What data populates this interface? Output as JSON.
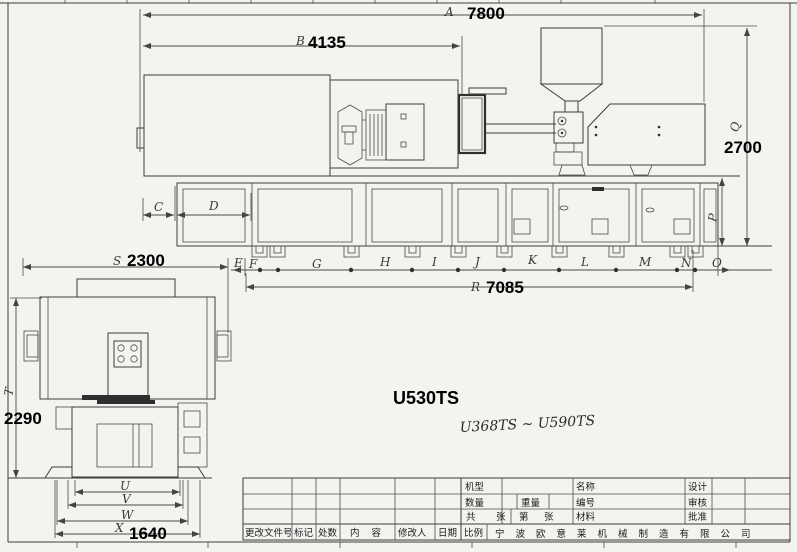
{
  "annotations": {
    "model_label": "U530TS",
    "model_range_note": "U368TS ~ U590TS"
  },
  "dimensions": {
    "overall_length": {
      "letter": "A",
      "value": "7800"
    },
    "injection_length": {
      "letter": "B",
      "value": "4135"
    },
    "machine_height": {
      "letter": "Q",
      "value": "2700"
    },
    "base_height_letter": "P",
    "c_letter": "C",
    "d_letter": "D",
    "foot_letters": [
      "E",
      "F",
      "G",
      "H",
      "I",
      "J",
      "K",
      "L",
      "M",
      "N",
      "O"
    ],
    "foot_span": {
      "letter": "R",
      "value": "7085"
    },
    "machine_width": {
      "letter": "S",
      "value": "2300"
    },
    "end_height": {
      "letter": "T",
      "value": "2290"
    },
    "u_letter": "U",
    "v_letter": "V",
    "w_letter": "W",
    "pedestal_width": {
      "letter": "X",
      "value": "1640"
    }
  },
  "title_block": {
    "machine_type_label": "机型",
    "quantity_label": "数量",
    "weight_label": "重量",
    "total_label": "共",
    "sheets_label": "张",
    "no_label": "第",
    "sheet_label": "张",
    "material_label": "材料",
    "name_label": "名称",
    "code_label": "编号",
    "design_label": "设计",
    "check_label": "审核",
    "approve_label": "批准",
    "scale_label": "比例",
    "change_file_label": "更改文件号",
    "mark_label": "标记",
    "count_label": "处数",
    "content_label": "内容",
    "reviser_label": "修改人",
    "date_label": "日期",
    "company_name": "宁波欧意莱机械制造有限公司"
  }
}
